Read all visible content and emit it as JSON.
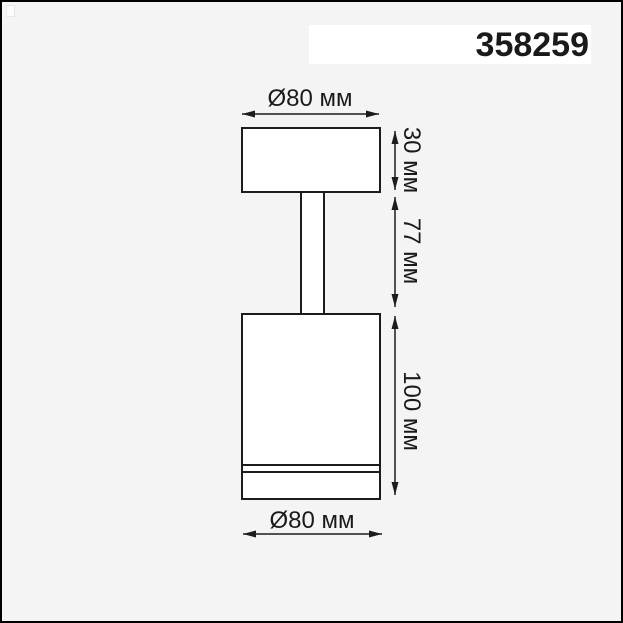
{
  "window": {
    "background_color": "#f4f4f4",
    "frame_border_color": "#000000"
  },
  "header": {
    "part_number": "358259",
    "part_number_bg": "#ffffff"
  },
  "diagram": {
    "subject": "cylindrical-spot-light-side-elevation",
    "line_color": "#1c1c1c",
    "fill_color": "#ffffff",
    "dimensions": [
      {
        "id": "top-diameter",
        "label": "Ø80 мм",
        "orientation": "horizontal",
        "value_mm": 80
      },
      {
        "id": "cap-height",
        "label": "30 мм",
        "orientation": "vertical",
        "value_mm": 30
      },
      {
        "id": "stem-height",
        "label": "77 мм",
        "orientation": "vertical",
        "value_mm": 77
      },
      {
        "id": "body-height",
        "label": "100 мм",
        "orientation": "vertical",
        "value_mm": 100
      },
      {
        "id": "bottom-diameter",
        "label": "Ø80 мм",
        "orientation": "horizontal",
        "value_mm": 80
      }
    ]
  }
}
